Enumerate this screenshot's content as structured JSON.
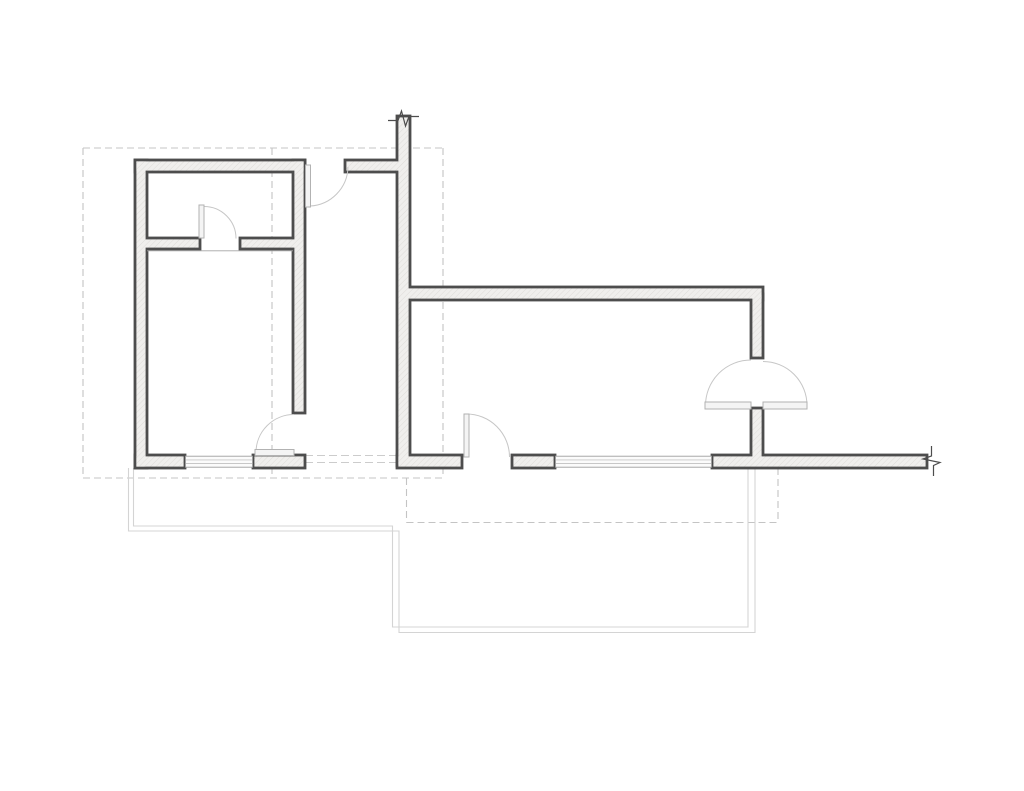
{
  "meta": {
    "width": 1024,
    "height": 791,
    "background": "#ffffff"
  },
  "plan": {
    "colors": {
      "wall_outline": "#4d4d4d",
      "wall_fill": "#f0efed",
      "hatch_line": "#dcdad7",
      "window_frame": "#9f9f9f",
      "window_line": "#c7c7c7",
      "window_fill": "#fbfbfb",
      "door_leaf_stroke": "#b2b2b2",
      "door_leaf_fill": "#f4f4f4",
      "door_arc": "#c6c6c6",
      "dashed_line": "#c4c4c4",
      "faint_dashed_line": "#cccccc",
      "terrace_line": "#d4d4d4",
      "face_line": "#a3a3a3"
    },
    "walls": [
      {
        "name": "left-block-top-wall",
        "x": 135,
        "y": 160,
        "w": 170,
        "h": 12
      },
      {
        "name": "left-block-left-wall",
        "x": 135,
        "y": 160,
        "w": 12,
        "h": 308
      },
      {
        "name": "left-block-right-wall",
        "x": 293,
        "y": 160,
        "w": 12,
        "h": 253
      },
      {
        "name": "partition-wall-left",
        "x": 141,
        "y": 238,
        "w": 59,
        "h": 11
      },
      {
        "name": "partition-wall-right",
        "x": 240,
        "y": 238,
        "w": 59,
        "h": 11
      },
      {
        "name": "top-stub-wall",
        "x": 345,
        "y": 160,
        "w": 58,
        "h": 12
      },
      {
        "name": "center-vertical-wall",
        "x": 397,
        "y": 116,
        "w": 13,
        "h": 350
      },
      {
        "name": "corridor-wall",
        "x": 400,
        "y": 287,
        "w": 363,
        "h": 13
      },
      {
        "name": "right-wall-upper",
        "x": 751,
        "y": 294,
        "w": 12,
        "h": 64
      },
      {
        "name": "right-wall-lower",
        "x": 751,
        "y": 408,
        "w": 12,
        "h": 50
      },
      {
        "name": "bottom-wall-1",
        "x": 135,
        "y": 455,
        "w": 50,
        "h": 13
      },
      {
        "name": "bottom-wall-2",
        "x": 253,
        "y": 455,
        "w": 52,
        "h": 13
      },
      {
        "name": "bottom-wall-3",
        "x": 397,
        "y": 455,
        "w": 65,
        "h": 13
      },
      {
        "name": "bottom-wall-4",
        "x": 512,
        "y": 455,
        "w": 43,
        "h": 13
      },
      {
        "name": "bottom-wall-5",
        "x": 712,
        "y": 455,
        "w": 215,
        "h": 13
      }
    ],
    "room_face_line": {
      "x1": 147,
      "y1": 250.8,
      "x2": 293,
      "y2": 250.8
    },
    "windows": [
      {
        "name": "window-left",
        "x": 185.5,
        "y": 456.2,
        "w": 67,
        "h": 11
      },
      {
        "name": "window-right",
        "x": 555.5,
        "y": 456.2,
        "w": 156,
        "h": 11
      }
    ],
    "door_leaves": [
      {
        "name": "partition-door-leaf",
        "x": 199,
        "y": 205,
        "w": 5,
        "h": 33
      },
      {
        "name": "entry-top-door-leaf",
        "x": 305.5,
        "y": 165,
        "w": 5,
        "h": 42
      },
      {
        "name": "bedroom-door-leaf",
        "x": 255,
        "y": 449.5,
        "w": 39,
        "h": 6
      },
      {
        "name": "hall-door-leaf",
        "x": 464,
        "y": 414,
        "w": 5,
        "h": 43
      },
      {
        "name": "double-door-leaf-left",
        "x": 705,
        "y": 402,
        "w": 46,
        "h": 7
      },
      {
        "name": "double-door-leaf-right",
        "x": 763,
        "y": 402,
        "w": 44,
        "h": 7
      }
    ],
    "door_arcs": [
      {
        "name": "partition-door-arc",
        "d": "M 204 206.5 A 32 32 0 0 1 236 238.5"
      },
      {
        "name": "entry-top-door-arc",
        "d": "M 310 206 A 40 40 0 0 0 348 167"
      },
      {
        "name": "bedroom-door-arc",
        "d": "M 256 452.5 A 38 38 0 0 1 294 414.5"
      },
      {
        "name": "hall-door-arc",
        "d": "M 466.5 414 A 43 43 0 0 1 509.5 457"
      },
      {
        "name": "double-door-arc-left",
        "d": "M 705.5 405.5 A 45.5 45.5 0 0 1 751 360"
      },
      {
        "name": "double-door-arc-right",
        "d": "M 763 361.5 A 44 44 0 0 1 807 405.5"
      }
    ],
    "dashed_segments": [
      {
        "name": "setback-top",
        "x1": 83,
        "y1": 148,
        "x2": 443,
        "y2": 148
      },
      {
        "name": "setback-left",
        "x1": 83,
        "y1": 148,
        "x2": 83,
        "y2": 478
      },
      {
        "name": "setback-bottom",
        "x1": 83,
        "y1": 478,
        "x2": 443,
        "y2": 478
      },
      {
        "name": "setback-right",
        "x1": 443,
        "y1": 148,
        "x2": 443,
        "y2": 478
      },
      {
        "name": "setback-mid-vertical",
        "x1": 272,
        "y1": 148,
        "x2": 272,
        "y2": 478
      },
      {
        "name": "setback2-left",
        "x1": 406.5,
        "y1": 478,
        "x2": 406.5,
        "y2": 522.5
      },
      {
        "name": "setback2-bottom",
        "x1": 406.5,
        "y1": 522.5,
        "x2": 778,
        "y2": 522.5
      },
      {
        "name": "setback2-right",
        "x1": 778,
        "y1": 457,
        "x2": 778,
        "y2": 522.5
      }
    ],
    "faint_dashed_segments": [
      {
        "name": "opening-dashed-upper",
        "x1": 305,
        "y1": 455.5,
        "x2": 397,
        "y2": 455.5
      },
      {
        "name": "opening-dashed-lower",
        "x1": 305,
        "y1": 462.5,
        "x2": 397,
        "y2": 462.5
      }
    ],
    "terrace_paths": [
      {
        "name": "terrace-outline-outer",
        "d": "M 128.5 468 L 128.5 531 L 399 531 L 399 632.5 L 755 632.5 L 755 468"
      },
      {
        "name": "terrace-outline-inner",
        "d": "M 133.5 468 L 133.5 526 L 392.5 526 L 392.5 627 L 748 627 L 748 468"
      }
    ],
    "break_marks": [
      {
        "name": "wall-break-top",
        "d": "M 388 120.5 L 398 120.5 L 401.5 111 L 405.5 126 L 409 116.5 L 419 116.5"
      },
      {
        "name": "wall-break-right",
        "d": "M 931.5 446 L 931.5 456 L 923 459 L 940 462.5 L 933.5 465.5 L 933.5 476"
      }
    ]
  }
}
